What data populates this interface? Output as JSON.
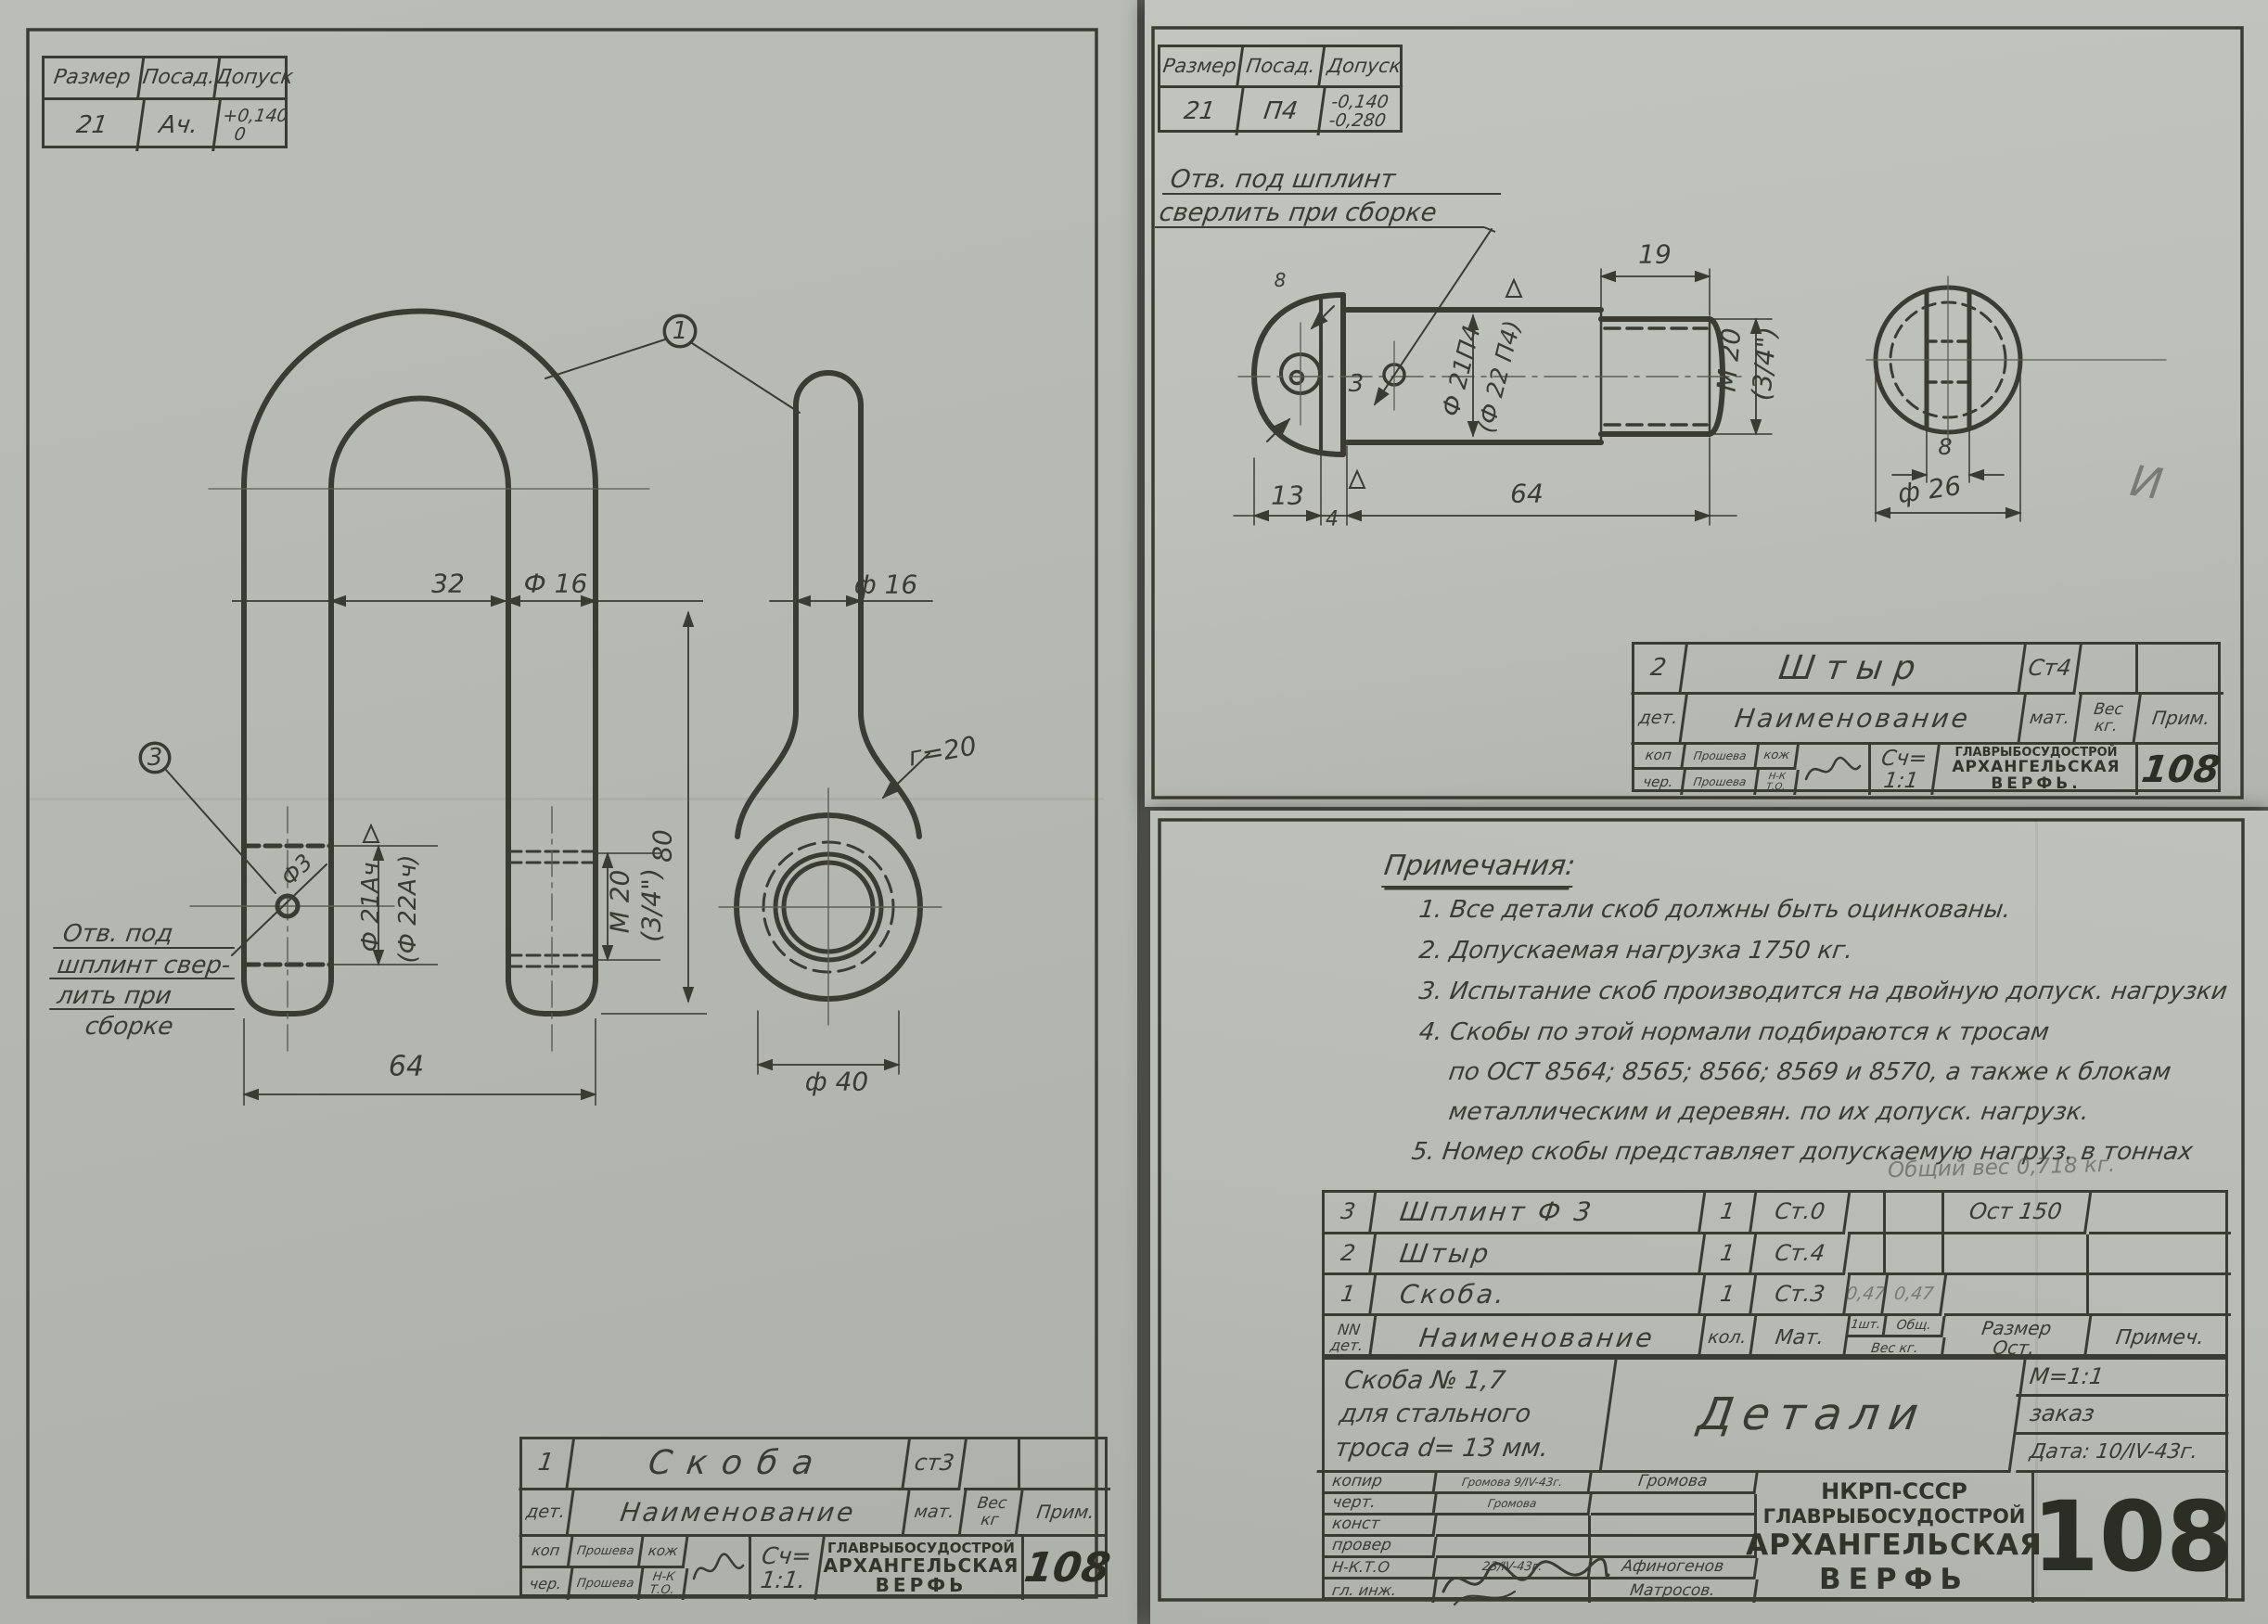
{
  "left": {
    "fit": {
      "h1": "Размер",
      "h2": "Посад.",
      "h3": "Допуск",
      "size": "21",
      "fit": "Ач.",
      "tol1": "+0,140",
      "tol2": "0"
    },
    "front": {
      "b1": "1",
      "b3": "3",
      "w_in": "32",
      "bar": "Ф 16",
      "h": "80",
      "w_out": "64",
      "d1": "Ф 21Ач",
      "d2": "(Ф 22Ач)",
      "m1": "М 20",
      "m2": "(3/4\")",
      "hole": "Ф3"
    },
    "note": {
      "l1": "Отв. под",
      "l2": "шплинт свер-",
      "l3": "лить при",
      "l4": "сборке"
    },
    "side": {
      "bar": "ф 16",
      "r": "г=20",
      "eye": "ф 40"
    },
    "tb": {
      "no": "1",
      "name": "Скоба",
      "mat": "ст3",
      "det": "дет.",
      "naim": "Наименование",
      "math": "мат.",
      "ves": "Вес",
      "kg": "кг",
      "prim": "Прим.",
      "kop": "коп",
      "kops": "Прошева",
      "kozh": "кож",
      "cher": "чер.",
      "chers": "Прошева",
      "nk": "Н-К",
      "to": "Т.О.",
      "sch": "Сч=",
      "scale": "1:1.",
      "f1": "ГЛАВРЫБОСУДОСТРОЙ",
      "f2": "АРХАНГЕЛЬСКАЯ",
      "f3": "ВЕРФЬ",
      "num": "108"
    }
  },
  "rtop": {
    "fit": {
      "h1": "Размер",
      "h2": "Посад.",
      "h3": "Допуск",
      "size": "21",
      "fit": "П4",
      "tol1": "-0,140",
      "tol2": "-0,280"
    },
    "note": {
      "l1": "Отв. под шплинт",
      "l2": "сверлить при сборке"
    },
    "pin": {
      "l19": "19",
      "m1": "М 20",
      "m2": "(3/4\")",
      "d1": "Ф 21П4",
      "d2": "(Ф 22 П4)",
      "hole": "3",
      "l13": "13",
      "l4": "4",
      "l64": "64",
      "s8": "8",
      "e8": "8",
      "d26": "ф 26",
      "mark": "И"
    },
    "tb": {
      "no": "2",
      "name": "Штыр",
      "mat": "Ст4",
      "det": "дет.",
      "naim": "Наименование",
      "math": "мат.",
      "ves": "Вес",
      "kg": "кг.",
      "prim": "Прим.",
      "kop": "коп",
      "kops": "Прошева",
      "kozh": "кож",
      "cher": "чер.",
      "chers": "Прошева",
      "nk": "Н-К",
      "to": "Т.О.",
      "sch": "Сч=",
      "scale": "1:1",
      "f1": "ГЛАВРЫБОСУДОСТРОЙ",
      "f2": "АРХАНГЕЛЬСКАЯ",
      "f3": "ВЕРФЬ.",
      "num": "108"
    }
  },
  "rbot": {
    "notes": {
      "heading": "Примечания:",
      "l1": "1. Все детали скоб должны быть оцинкованы.",
      "l2": "2. Допускаемая нагрузка 1750 кг.",
      "l3": "3. Испытание скоб производится на двойную допуск. нагрузки",
      "l4": "4. Скобы по этой нормали подбираются к тросам",
      "l5": "по ОСТ 8564; 8565; 8566; 8569 и 8570, а также к блокам",
      "l6": "металлическим и деревян. по их допуск. нагрузк.",
      "l7": "5. Номер скобы представляет допускаемую нагруз. в тоннах"
    },
    "pencil": "Общий вес 0,718 кг.",
    "parts": {
      "hdr": {
        "nn": "NN",
        "det": "дет.",
        "naim": "Наименование",
        "kol": "кол.",
        "mat": "Мат.",
        "w1": "1шт.",
        "w2": "Общ.",
        "ves": "Вес кг.",
        "raz": "Размер",
        "ost": "Ост.",
        "prim": "Примеч."
      },
      "rows": [
        {
          "no": "3",
          "name": "Шплинт Ф 3",
          "qty": "1",
          "mat": "Ст.0",
          "wa": "",
          "wb": "",
          "size": "Ост 150",
          "note": ""
        },
        {
          "no": "2",
          "name": "Штыр",
          "qty": "1",
          "mat": "Ст.4",
          "wa": "",
          "wb": "",
          "size": "",
          "note": ""
        },
        {
          "no": "1",
          "name": "Скоба.",
          "qty": "1",
          "mat": "Ст.3",
          "wa": "0,47",
          "wb": "0,47",
          "size": "",
          "note": ""
        }
      ]
    },
    "mt": {
      "s1": "Скоба № 1,7",
      "s2": "для стального",
      "s3": "троса d= 13 мм.",
      "doc": "Детали",
      "scale": "М=1:1",
      "order": "заказ",
      "date": "Дата: 10/IV-43г.",
      "rows": [
        {
          "label": "копир",
          "sign": "Громова 9/IV-43г.",
          "name": "Громова"
        },
        {
          "label": "черт.",
          "sign": "Громова",
          "name": ""
        },
        {
          "label": "конст",
          "sign": "",
          "name": ""
        },
        {
          "label": "провер",
          "sign": "",
          "name": ""
        },
        {
          "label": "Н-К.Т.О",
          "sign": "23/IV-43г.",
          "name": "Афиногенов"
        },
        {
          "label": "гл. инж.",
          "sign": "",
          "name": "Матросов."
        }
      ],
      "org1": "НКРП-СССР",
      "org2": "ГЛАВРЫБОСУДОСТРОЙ",
      "org3": "АРХАНГЕЛЬСКАЯ",
      "org4": "ВЕРФЬ",
      "num": "108"
    }
  }
}
